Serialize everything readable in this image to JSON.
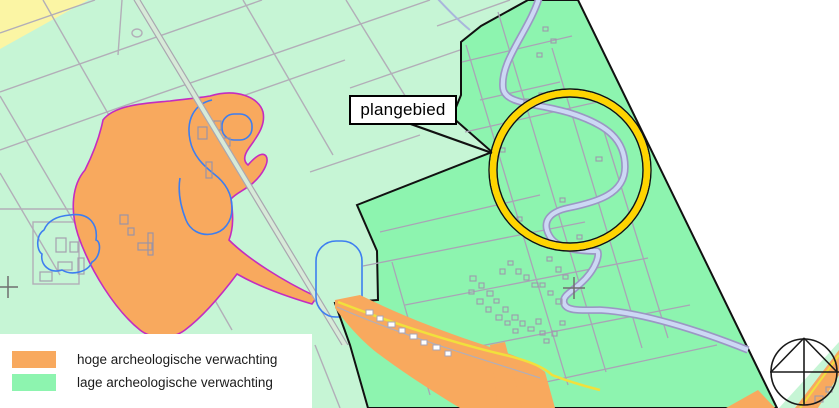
{
  "map": {
    "label": "plangebied"
  },
  "legend": {
    "items": [
      {
        "label": "hoge archeologische verwachting",
        "color": "#F8A95E"
      },
      {
        "label": "lage archeologische verwachting",
        "color": "#8DF4AF"
      }
    ]
  },
  "colors": {
    "high_expectation": "#F8A95E",
    "high_expectation_outline": "#C42CC0",
    "low_expectation_light": "#C6F5D5",
    "low_expectation_dark": "#8DF4AF",
    "corner_yellow": "#FBF5A4",
    "highlight_circle": "#FFD400",
    "water_blue": "#CCD8F4",
    "contour_blue": "#3D7EF0",
    "parcel_line": "#B2AEB8",
    "plan_boundary": "#111111"
  }
}
